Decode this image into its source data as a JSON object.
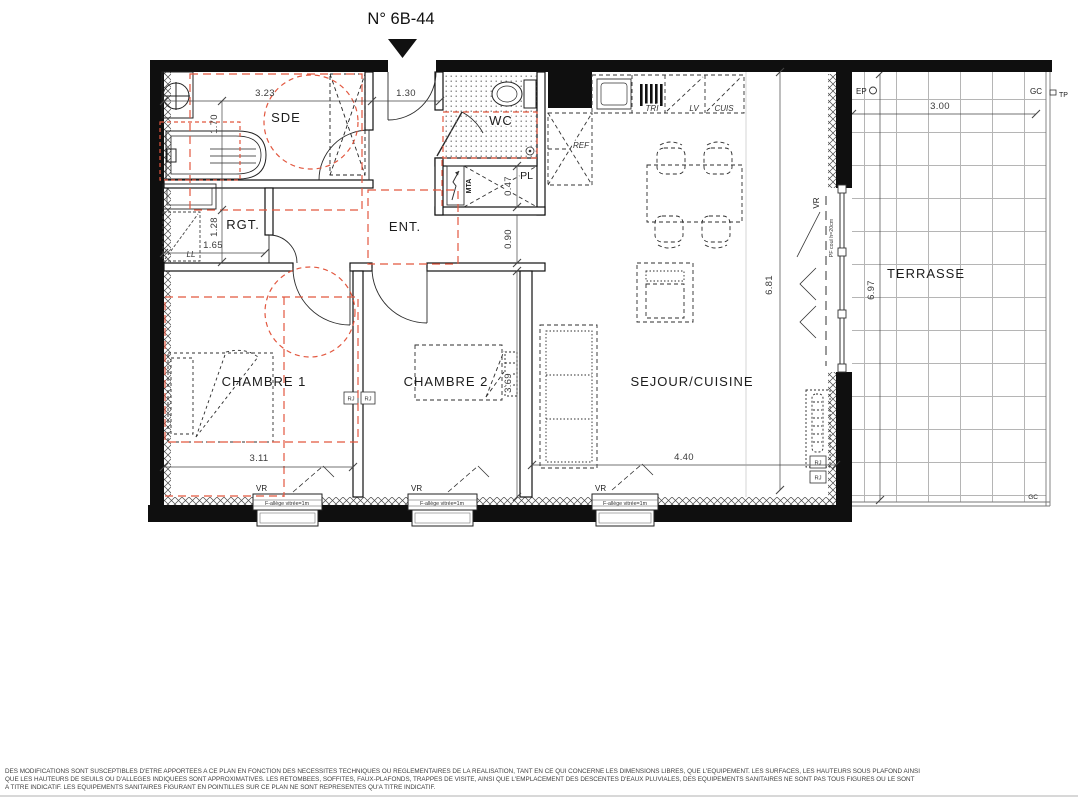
{
  "title": "N° 6B-44",
  "rooms": {
    "sde": "SDE",
    "wc": "WC",
    "pl": "PL",
    "rgt": "RGT.",
    "ent": "ENT.",
    "chambre1": "CHAMBRE 1",
    "chambre2": "CHAMBRE 2",
    "sejour": "SEJOUR/CUISINE",
    "terrasse": "TERRASSE"
  },
  "dimensions": {
    "sde_width": "3.23",
    "entry_door": "1.30",
    "sde_height": "1.70",
    "rgt_height": "1.28",
    "rgt_width": "1.65",
    "pl_width": "0.47",
    "hall_width": "0.90",
    "chambre1_width": "3.11",
    "chambre2_height": "3.69",
    "sejour_width": "4.40",
    "sejour_height": "6.81",
    "terrasse_width": "3.00",
    "terrasse_height": "6.97"
  },
  "equipment": {
    "tri": "TRI",
    "lv": "LV",
    "cuis": "CUIS",
    "ref": "REF",
    "ll": "LL",
    "mta": "MTA",
    "vr": "VR",
    "bay_note": "PF coul h=20cm",
    "rj": "RJ",
    "ep": "EP",
    "gc": "GC",
    "tp": "TP",
    "window_note": "F-allège vitrée=1m"
  },
  "disclaimer": {
    "line1": "DES MODIFICATIONS SONT SUSCEPTIBLES D'ETRE APPORTEES A CE PLAN EN FONCTION DES NECESSITES TECHNIQUES OU REGLEMENTAIRES DE LA REALISATION, TANT EN CE QUI CONCERNE LES DIMENSIONS LIBRES, QUE L'EQUIPEMENT. LES SURFACES, LES HAUTEURS SOUS PLAFOND AINSI",
    "line2": "QUE LES HAUTEURS DE SEUILS OU D'ALLEGES INDIQUEES SONT APPROXIMATIVES. LES RETOMBEES, SOFFITES, FAUX-PLAFONDS, TRAPPES DE VISITE, AINSI QUE L'EMPLACEMENT DES DESCENTES D'EAUX PLUVIALES, DES EQUIPEMENTS SANITAIRES NE SONT PAS TOUS FIGURES OU LE SONT",
    "line3": "A TITRE INDICATIF. LES EQUIPEMENTS SANITAIRES FIGURANT EN POINTILLES SUR CE PLAN NE SONT REPRESENTES QU'A TITRE INDICATIF."
  },
  "colors": {
    "line": "#1a1a1a",
    "red": "#e2573f"
  }
}
